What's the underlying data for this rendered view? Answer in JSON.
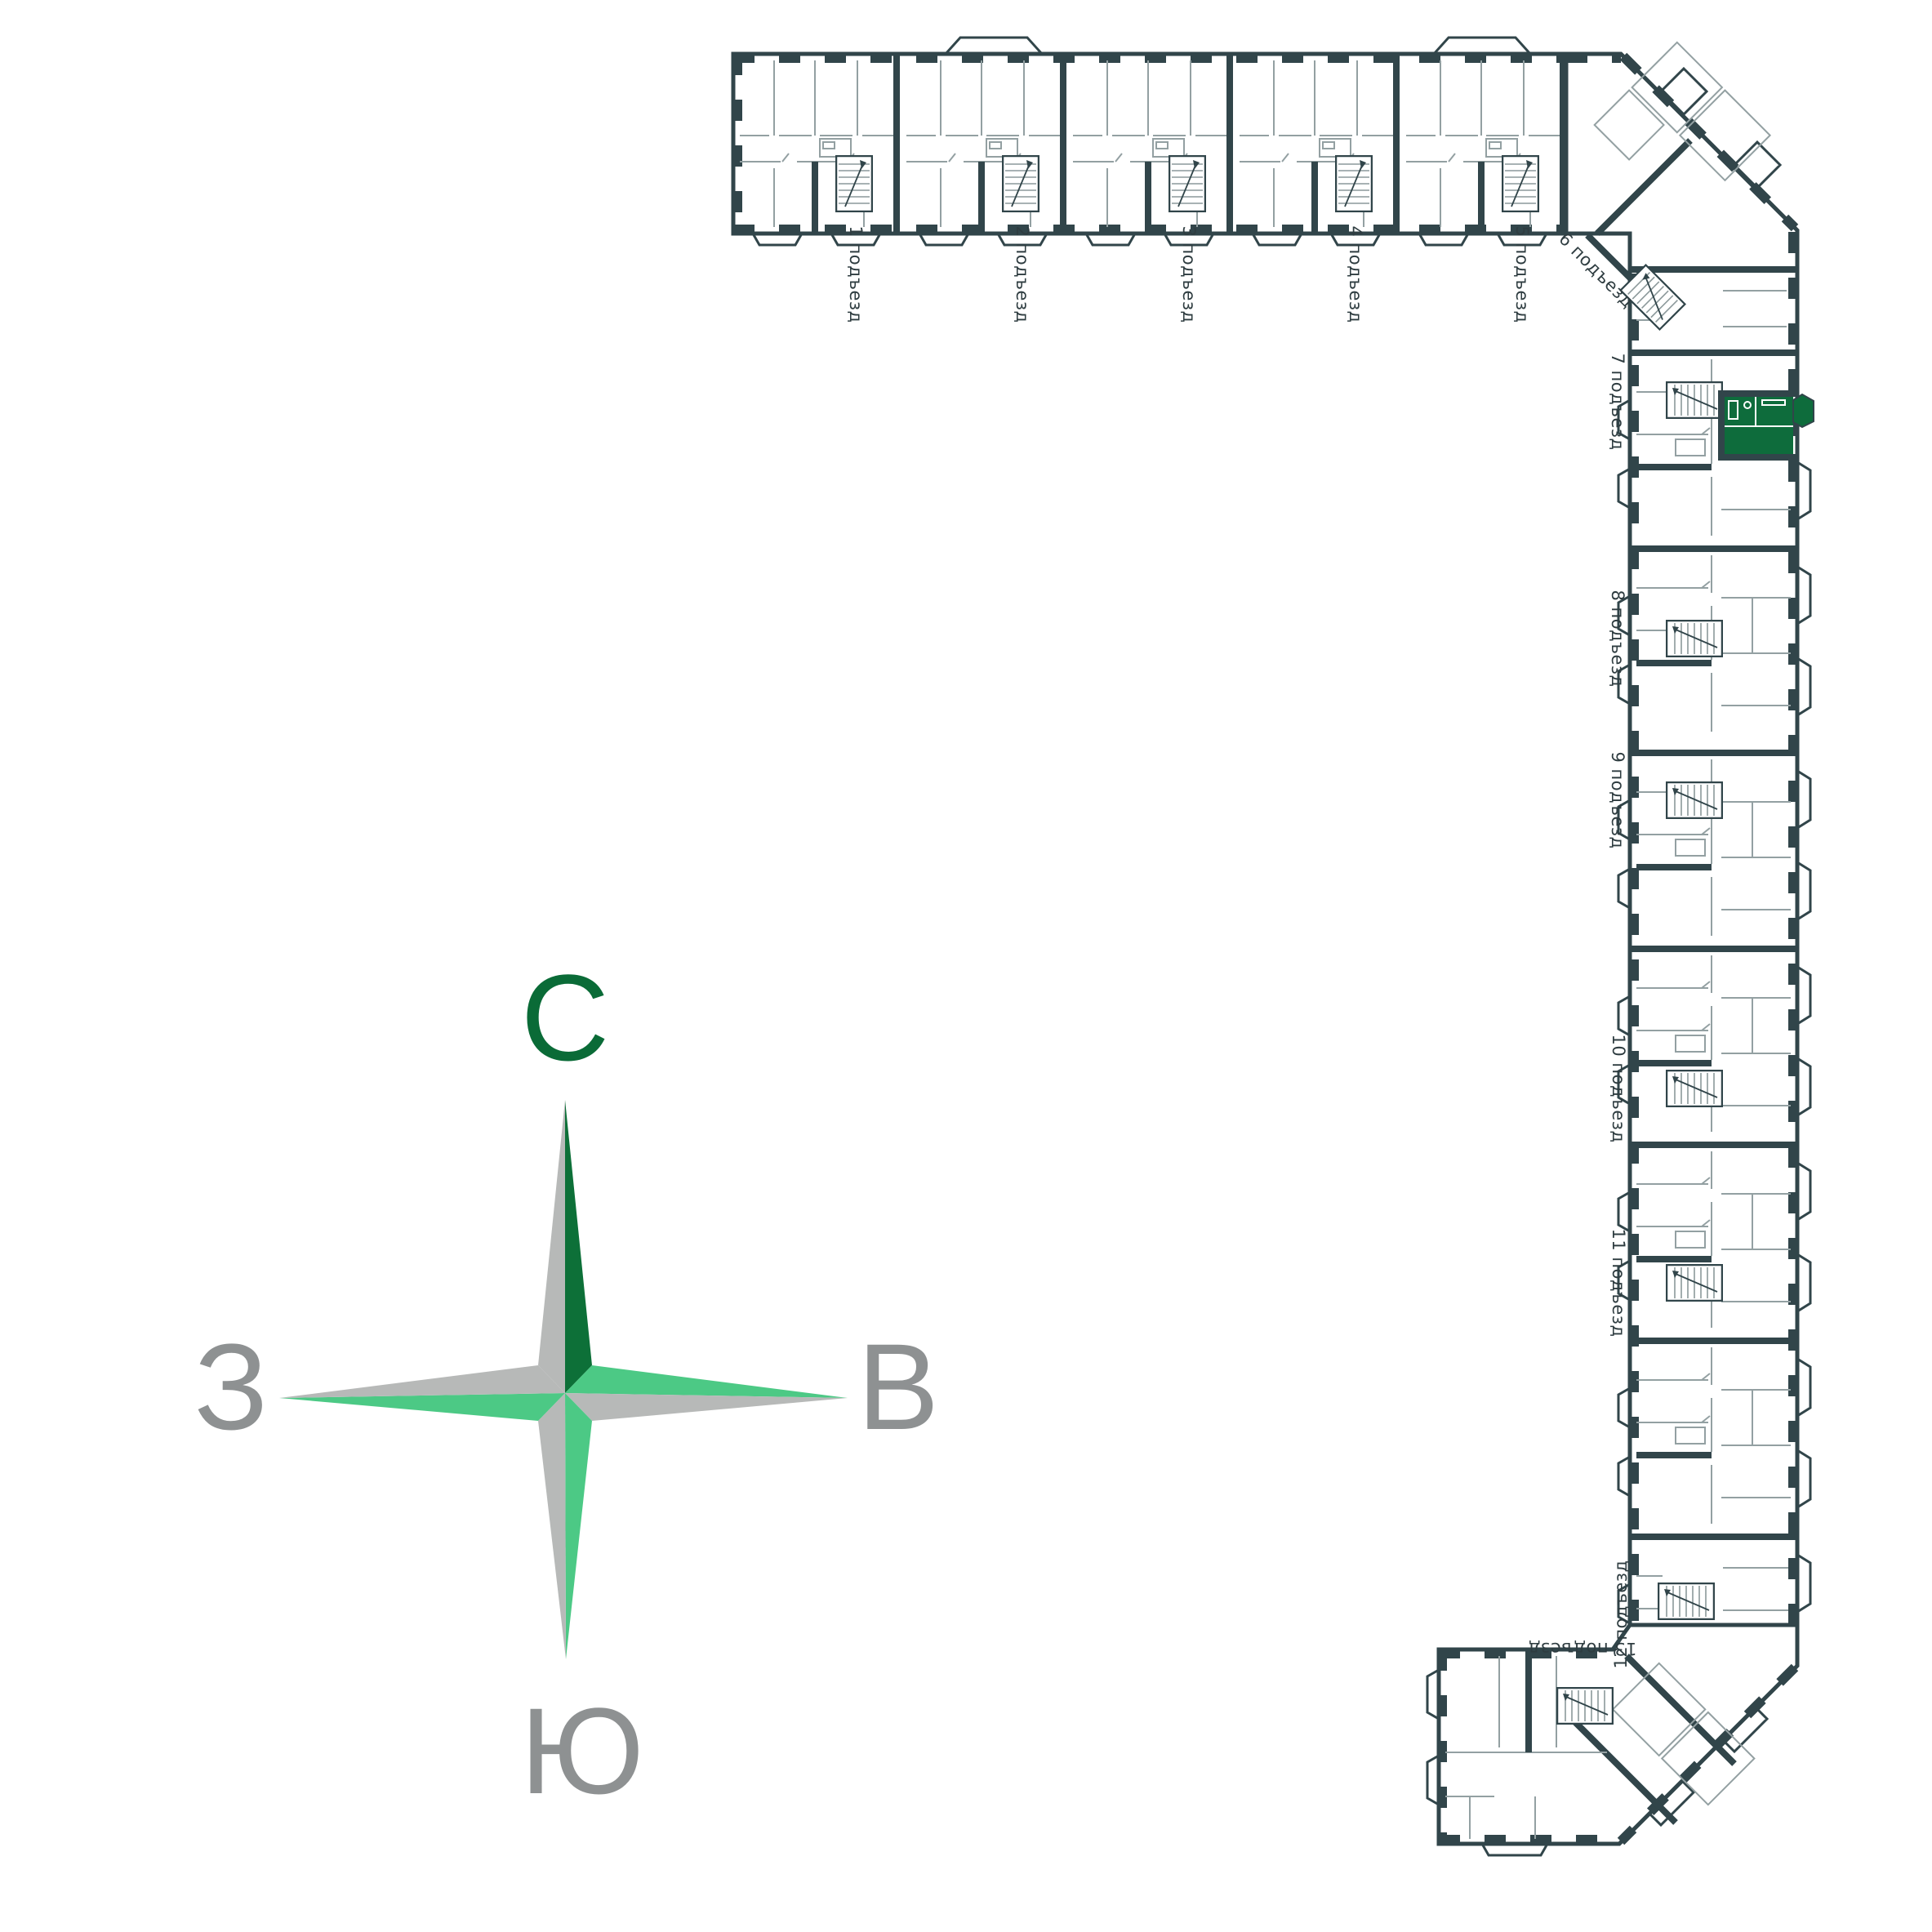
{
  "floor_plan": {
    "wall_color": "#31454A",
    "thin_line_color": "#93A0A2",
    "label_color": "#2E3C40",
    "entrances": [
      {
        "label": "1 подъезд"
      },
      {
        "label": "2 подъезд"
      },
      {
        "label": "3 подъезд"
      },
      {
        "label": "4 подъезд"
      },
      {
        "label": "5 подъезд"
      },
      {
        "label": "6 подъезд"
      },
      {
        "label": "7 подъезд"
      },
      {
        "label": "8 подъезд"
      },
      {
        "label": "9 подъезд"
      },
      {
        "label": "10 подъезд"
      },
      {
        "label": "11 подъезд"
      },
      {
        "label": "12 подъезд"
      },
      {
        "label": "13 подъезд"
      }
    ],
    "highlighted_apartment": {
      "section_label": "7 подъезд",
      "color": "#0E6C3C"
    }
  },
  "compass": {
    "north": {
      "label": "С",
      "color": "#0A6B37"
    },
    "east": {
      "label": "В",
      "color": "#8E9192"
    },
    "south": {
      "label": "Ю",
      "color": "#8E9192"
    },
    "west": {
      "label": "З",
      "color": "#8E9192"
    },
    "arm_dark_green": "#0D7038",
    "arm_light_green": "#4CC985",
    "arm_gray": "#B7B9B8"
  }
}
